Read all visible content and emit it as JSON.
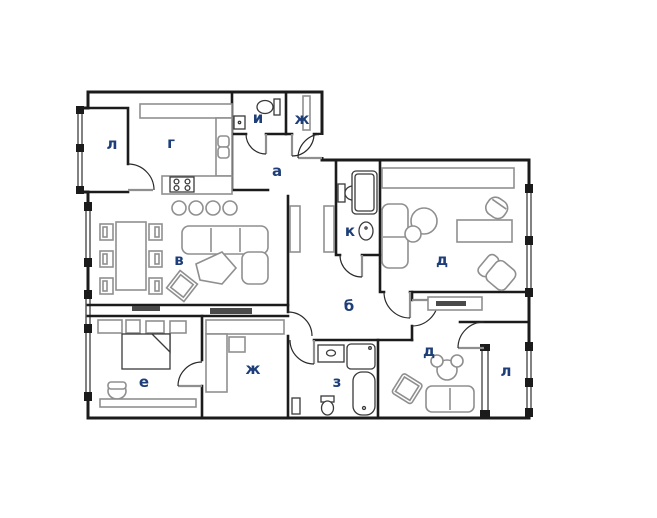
{
  "plan": {
    "title": "apartment-floor-plan",
    "colors": {
      "wall": "#1b1b1b",
      "furniture": "#8f8f8f",
      "label": "#1d3e78",
      "background": "#ffffff"
    },
    "rooms": {
      "loggia_tl": {
        "label": "л"
      },
      "kitchen": {
        "label": "г"
      },
      "wc_small": {
        "label": "и"
      },
      "storage_top": {
        "label": "ж"
      },
      "hallway": {
        "label": "а"
      },
      "bathroom_main": {
        "label": "к"
      },
      "living": {
        "label": "в"
      },
      "corridor": {
        "label": "б"
      },
      "bedroom_tr": {
        "label": "д"
      },
      "bedroom_left": {
        "label": "е"
      },
      "dressing": {
        "label": "ж"
      },
      "bathroom_second": {
        "label": "з"
      },
      "bedroom_br": {
        "label": "д"
      },
      "loggia_br": {
        "label": "л"
      }
    }
  }
}
